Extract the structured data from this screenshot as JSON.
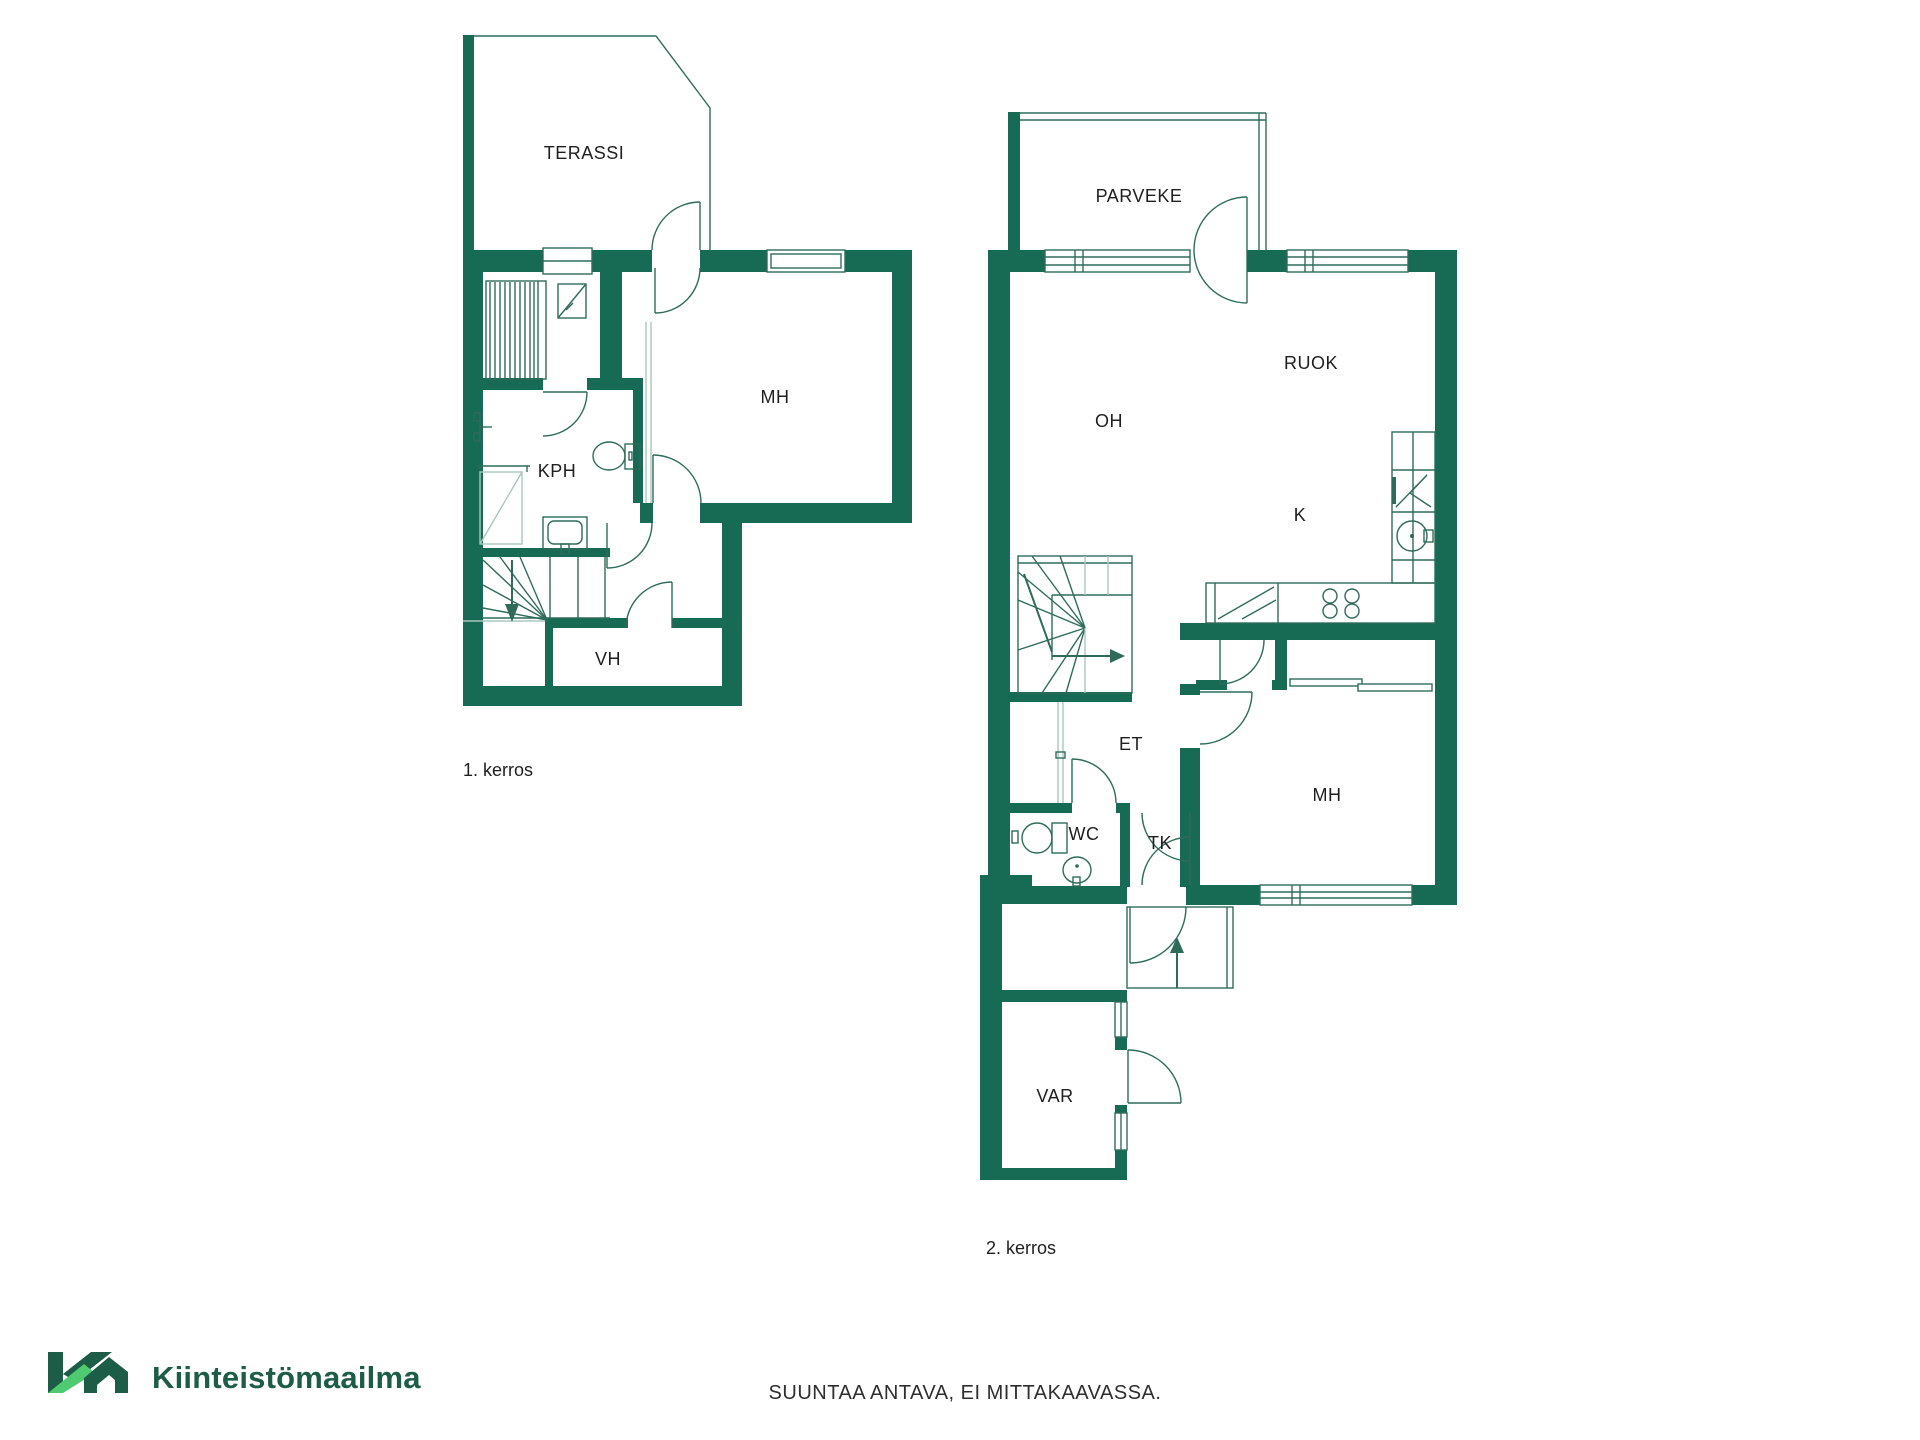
{
  "colors": {
    "wall": "#176a53",
    "line": "#2f6b5b",
    "light_line": "#a8c8bd",
    "text": "#1f1f1f",
    "footer_text": "#2e2e2e",
    "logo_dark": "#1d5c47",
    "logo_light": "#4ecb71"
  },
  "floor1": {
    "name": "1. kerros",
    "rooms": {
      "terassi": "TERASSI",
      "mh": "MH",
      "kph": "KPH",
      "vh": "VH"
    }
  },
  "floor2": {
    "name": "2. kerros",
    "rooms": {
      "parveke": "PARVEKE",
      "oh": "OH",
      "ruok": "RUOK",
      "k": "K",
      "et": "ET",
      "wc": "WC",
      "tk": "TK",
      "mh": "MH",
      "var": "VAR"
    }
  },
  "footer": {
    "disclaimer": "SUUNTAA ANTAVA, EI MITTAKAAVASSA."
  },
  "logo": {
    "monogram": "KM",
    "brand": "Kiinteistömaailma"
  }
}
